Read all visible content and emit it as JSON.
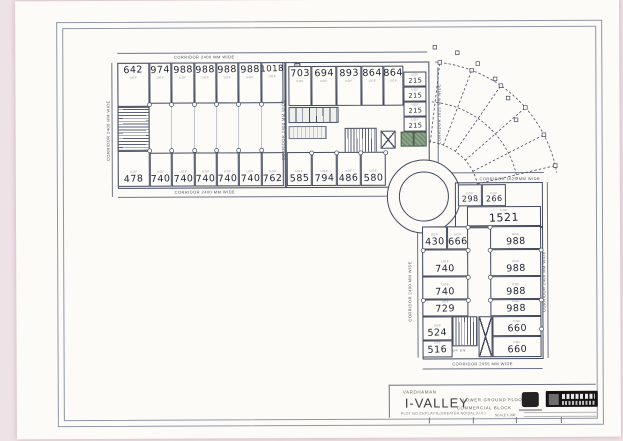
{
  "palette": {
    "paper": "#fcfbf7",
    "pink": "#efe2e7",
    "line": "#434a5e",
    "ink": "#1d2336",
    "green": "#8fa58b"
  },
  "unit_tag": "UGF",
  "marker_d": "D",
  "stair": {
    "up": "UP",
    "dn": "DN"
  },
  "corridors": {
    "left_top": "CORRIDOR 2400 MM WIDE",
    "left_bottom": "CORRIDOR 2400 MM WIDE",
    "left_side": "CORRIDOR 2400 MM WIDE",
    "mid_side": "CORRIDOR 2400 MM WIDE",
    "fan_side": "CORRIDOR 1625 MM WIDE",
    "right_top": "CORRIDOR 1625 MM WIDE",
    "right_bottom": "CORRIDOR 2055 MM WIDE",
    "right_left": "CORRIDOR 2400 MM WIDE",
    "right_right": "CORRIDOR 2400 MM WIDE"
  },
  "blocks": {
    "left": {
      "top": [
        "642",
        "974",
        "988",
        "988",
        "988",
        "988",
        "1018"
      ],
      "bottom": [
        "478",
        "740",
        "740",
        "740",
        "740",
        "740",
        "762"
      ]
    },
    "middle": {
      "top": [
        "703",
        "694",
        "893",
        "864",
        "864"
      ],
      "side": [
        "215",
        "215",
        "215",
        "215"
      ],
      "bottom": [
        "585",
        "794",
        "486",
        "580"
      ]
    },
    "right": {
      "small": [
        "298",
        "266"
      ],
      "wide": "1521",
      "left_col": [
        "430",
        "666",
        "740",
        "740",
        "729",
        "524",
        "516"
      ],
      "right_col": [
        "988",
        "988",
        "988",
        "988",
        "660",
        "660"
      ]
    }
  },
  "title_block": {
    "firm": "VARDHAMAN",
    "project": "I-VALLEY",
    "plot": "PLOT NO.25(P),AY-8,(GREATER NOIDA),(U.P.)",
    "floor": "LOWER GROUND FLOOR",
    "block": "COMMERCIAL BLOCK",
    "scale": "SCALE 1:200"
  }
}
